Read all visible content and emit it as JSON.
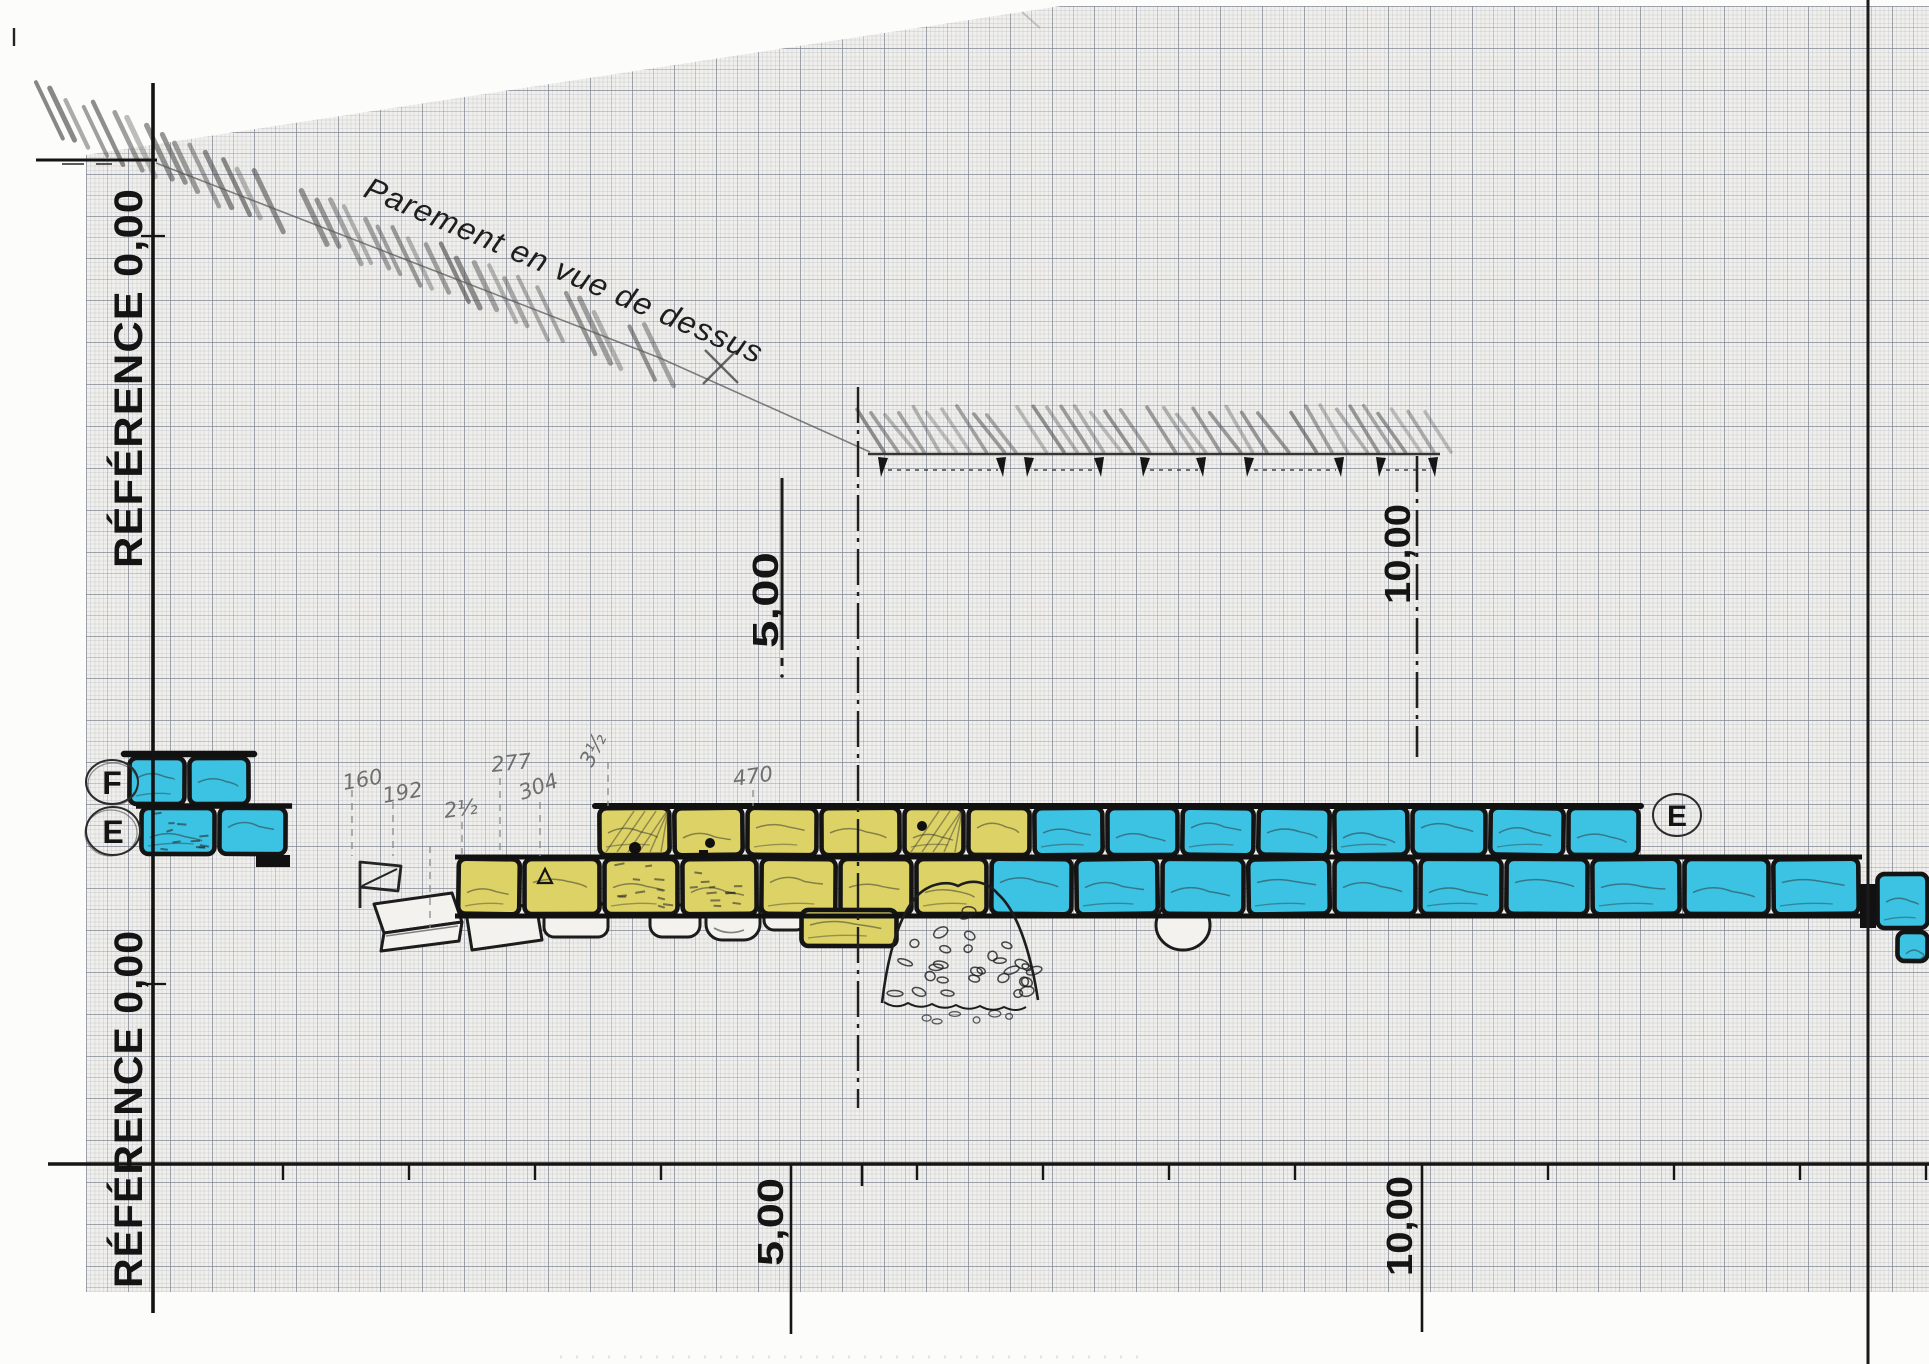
{
  "labels": {
    "reference_top": "RÉFÉRENCE 0,00",
    "reference_bottom": "RÉFÉRENCE 0,00",
    "title": "Parement en vue de dessus",
    "station_5_top": "5,00",
    "station_10_top": "10,00",
    "station_5_bottom": "5,00",
    "station_10_bottom": "10,00",
    "marker_f": "F",
    "marker_e_left": "E",
    "marker_e_right": "E"
  },
  "measurements": {
    "m160": "160",
    "m192": "192",
    "m2half": "2½",
    "m277": "277",
    "m304": "304",
    "m3half": "3½",
    "m470": "470"
  },
  "colors": {
    "stone_cyan": "#3cc2e2",
    "stone_yellow": "#dcd266",
    "ink": "#141414",
    "pencil": "#6f6f6f",
    "paper": "#f0efec"
  }
}
